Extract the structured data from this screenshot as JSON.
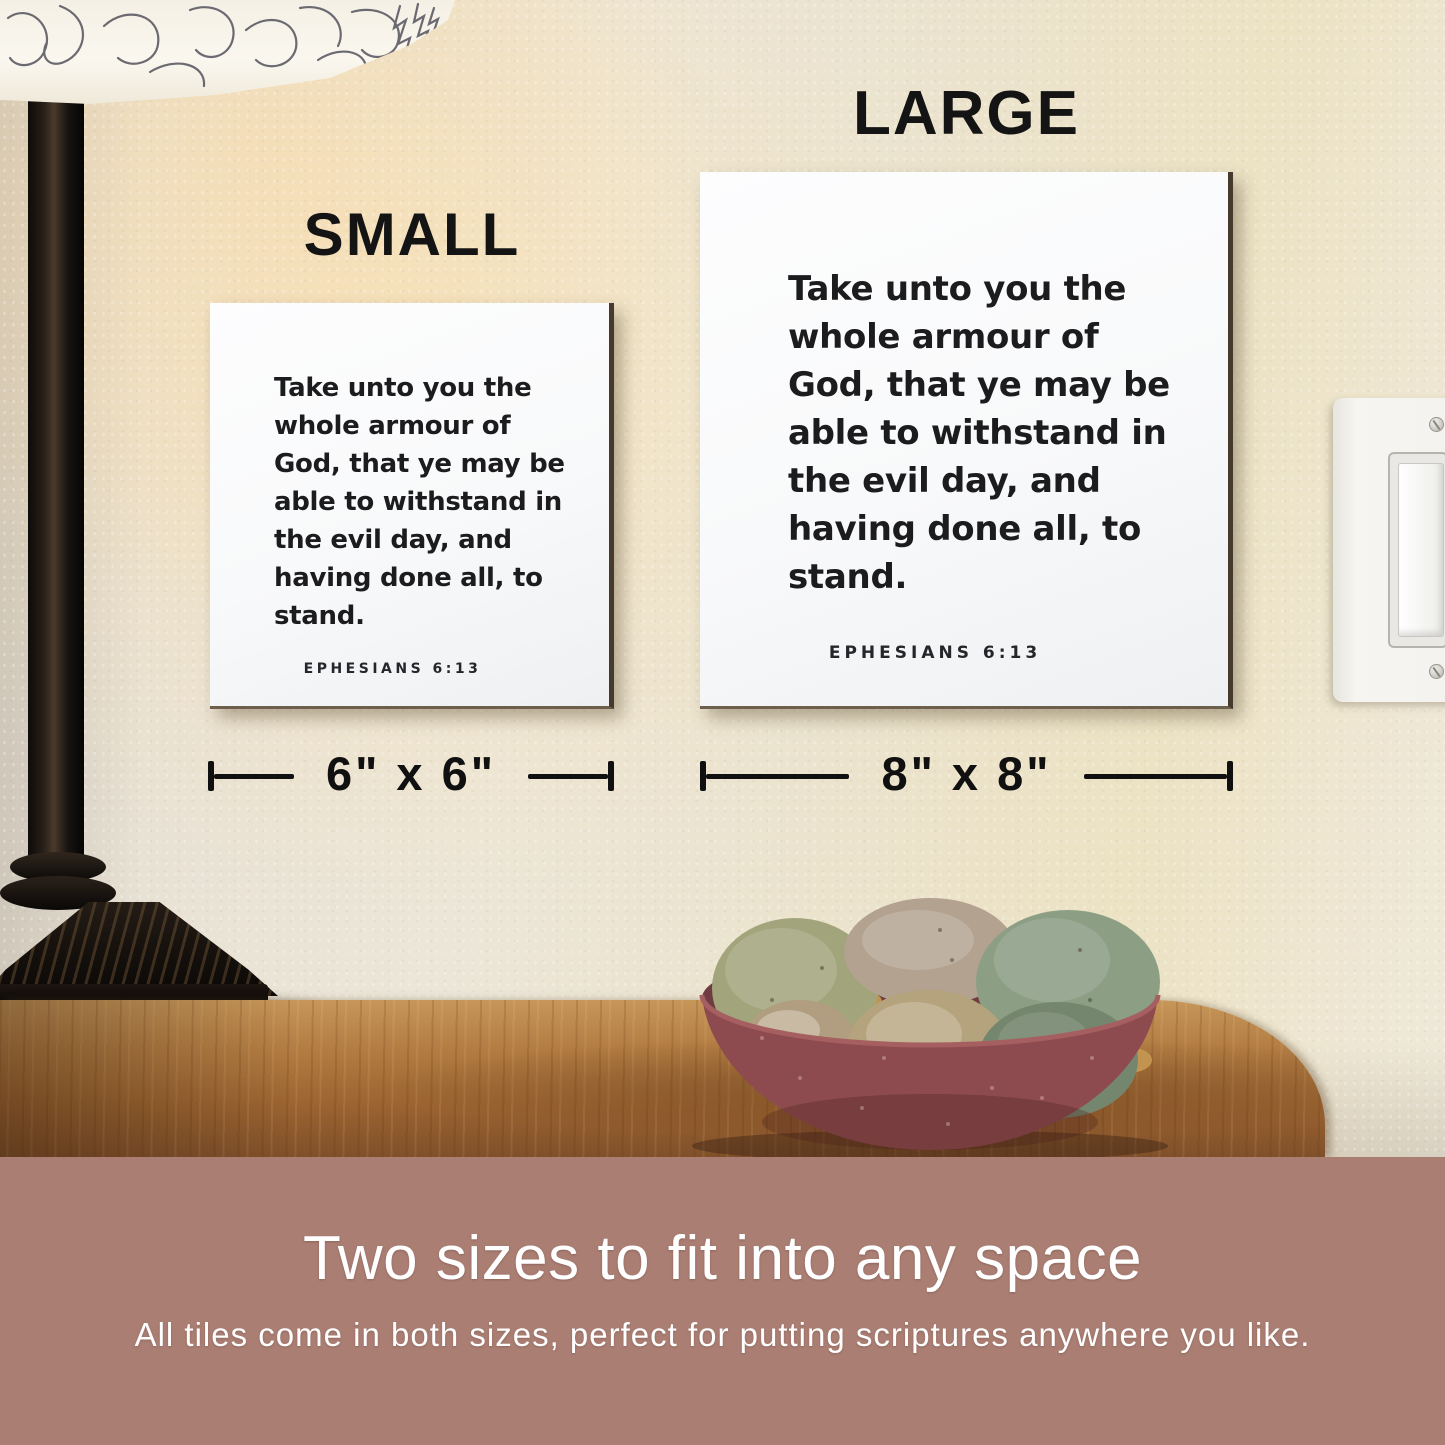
{
  "photo": {
    "size_labels": {
      "small": "SMALL",
      "large": "LARGE"
    },
    "dimension_labels": {
      "small": "6\" x 6\"",
      "large": "8\" x 8\""
    },
    "verse": {
      "lines": [
        "Take unto you the",
        "whole armour of",
        "God, that ye may be",
        "able to withstand in",
        "the evil day, and",
        "having done all, to",
        "stand."
      ],
      "reference": "EPHESIANS 6:13"
    },
    "scene_objects": {
      "lamp": "table-lamp-with-leaf-pattern-shade",
      "light_switch": "white-rocker-light-switch",
      "bowl": "red-ceramic-bowl-of-river-stones",
      "table": "wood-console-table",
      "wall": "cream-textured-wall"
    }
  },
  "banner": {
    "title": "Two sizes to fit into any space",
    "subtitle": "All tiles come in both sizes, perfect for putting scriptures anywhere you like."
  },
  "colors": {
    "banner_bg": "#aa7e73",
    "banner_text": "#ffffff",
    "overlay_text": "#121212",
    "tile_bg": "#fafbfc",
    "tile_text": "#1c1c1e",
    "wall": "#e9e2d2",
    "table_wood": "#a76f38",
    "bowl": "#8d4b4f"
  }
}
